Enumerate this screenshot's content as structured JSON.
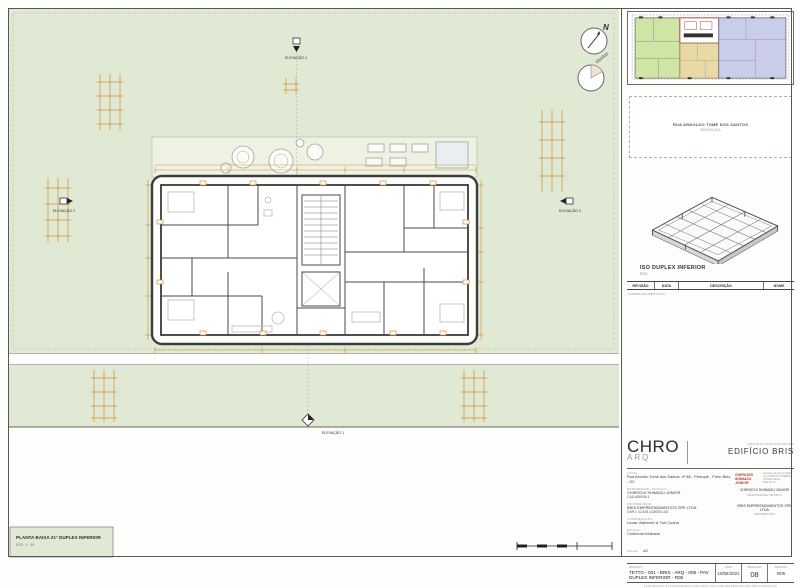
{
  "colors": {
    "site_green": "#e0e9d3",
    "dims_orange": "#d28e35",
    "unit_green": "#cfe5a5",
    "unit_tan": "#e9d9a7",
    "unit_blue": "#c9cde9",
    "core_red": "#b2423a"
  },
  "plan": {
    "title": "PLANTA BAIXA 21° DUPLEX INFERIOR",
    "scale": "ESC: 1 : 50",
    "north_label": "N",
    "winds_label": "Ventos",
    "elevation_top": "ELEVAÇÃO 4",
    "elevation_bottom": "ELEVAÇÃO 1",
    "elevation_left": "ELEVAÇÃO 2",
    "elevation_right": "ELEVAÇÃO 3"
  },
  "panel": {
    "lot_note_line1": "RUA ARNOLDO TOMÉ DOS SANTOS",
    "lot_note_line2": "SEM ESCALA",
    "iso_title": "ISO DUPLEX INFERIOR",
    "iso_scale": "ESC:",
    "rev_cols": [
      "REVISÃO",
      "DATA",
      "DESCRIÇÃO",
      "NOME"
    ],
    "rev_note": "CARIMBO DE APROVAÇÃO"
  },
  "title_block": {
    "logo": "CHRO",
    "logo_sub": "ARQ",
    "project_label": "PROJETO ARQUITETÔNICO",
    "project_name": "EDIFÍCIO BRIS",
    "local_label": "LOCAL:",
    "local": "Rua Arnoldo Tomé dos Santos, nº 88 - Perequê - Porto Belo - SC",
    "resp_label": "RESPONSÁVEL TÉCNICO:",
    "resp": "CHIROCHI SHIMAZU JÚNIOR",
    "resp_cau": "CAU A56936-1",
    "prop_label": "PROPRIETÁRIO:",
    "prop": "BRIS EMPREENDIMENTOS SPE LTDA",
    "prop_cnpj": "CNPJ: 42.528.143/0001-53",
    "coord_label": "COORDENAÇÃO:",
    "coord": "Lucas Valkovich & Yuri Cunha",
    "escala_label": "ESCALA:",
    "escala": "Conforme Indicado",
    "folha_label": "FOLHA:",
    "folha": "A2",
    "stamp_name": "CHIROCHI SHIMAZU JÚNIOR",
    "stamp_note": "Assinado de forma digital por CHIROCHI SHIMAZU JÚNIOR Dados: 2021.06.10",
    "sig_name": "CHIROCHI SHIMAZU JÚNIOR",
    "sig_role": "RESPONSÁVEL TÉCNICO",
    "owner_name": "BRIS EMPREENDIMENTOS SPE LTDA",
    "owner_role": "PROPRIETÁRIO",
    "assunto_label": "ASSUNTO:",
    "assunto": "TETTO - 001 - BRIS - ARQ - 008 - PAV DUPLEX INFERIOR - R05",
    "data_label": "DATA",
    "data": "10/06/2021",
    "prancha_label": "PRANCHA",
    "prancha": "08",
    "revisao_label": "REVISÃO",
    "revisao": "R05",
    "footer": "ESTE DESENHO É PROPRIEDADE DA CHRO ARQ E NÃO PODE SER REPRODUZIDO SEM AUTORIZAÇÃO"
  }
}
